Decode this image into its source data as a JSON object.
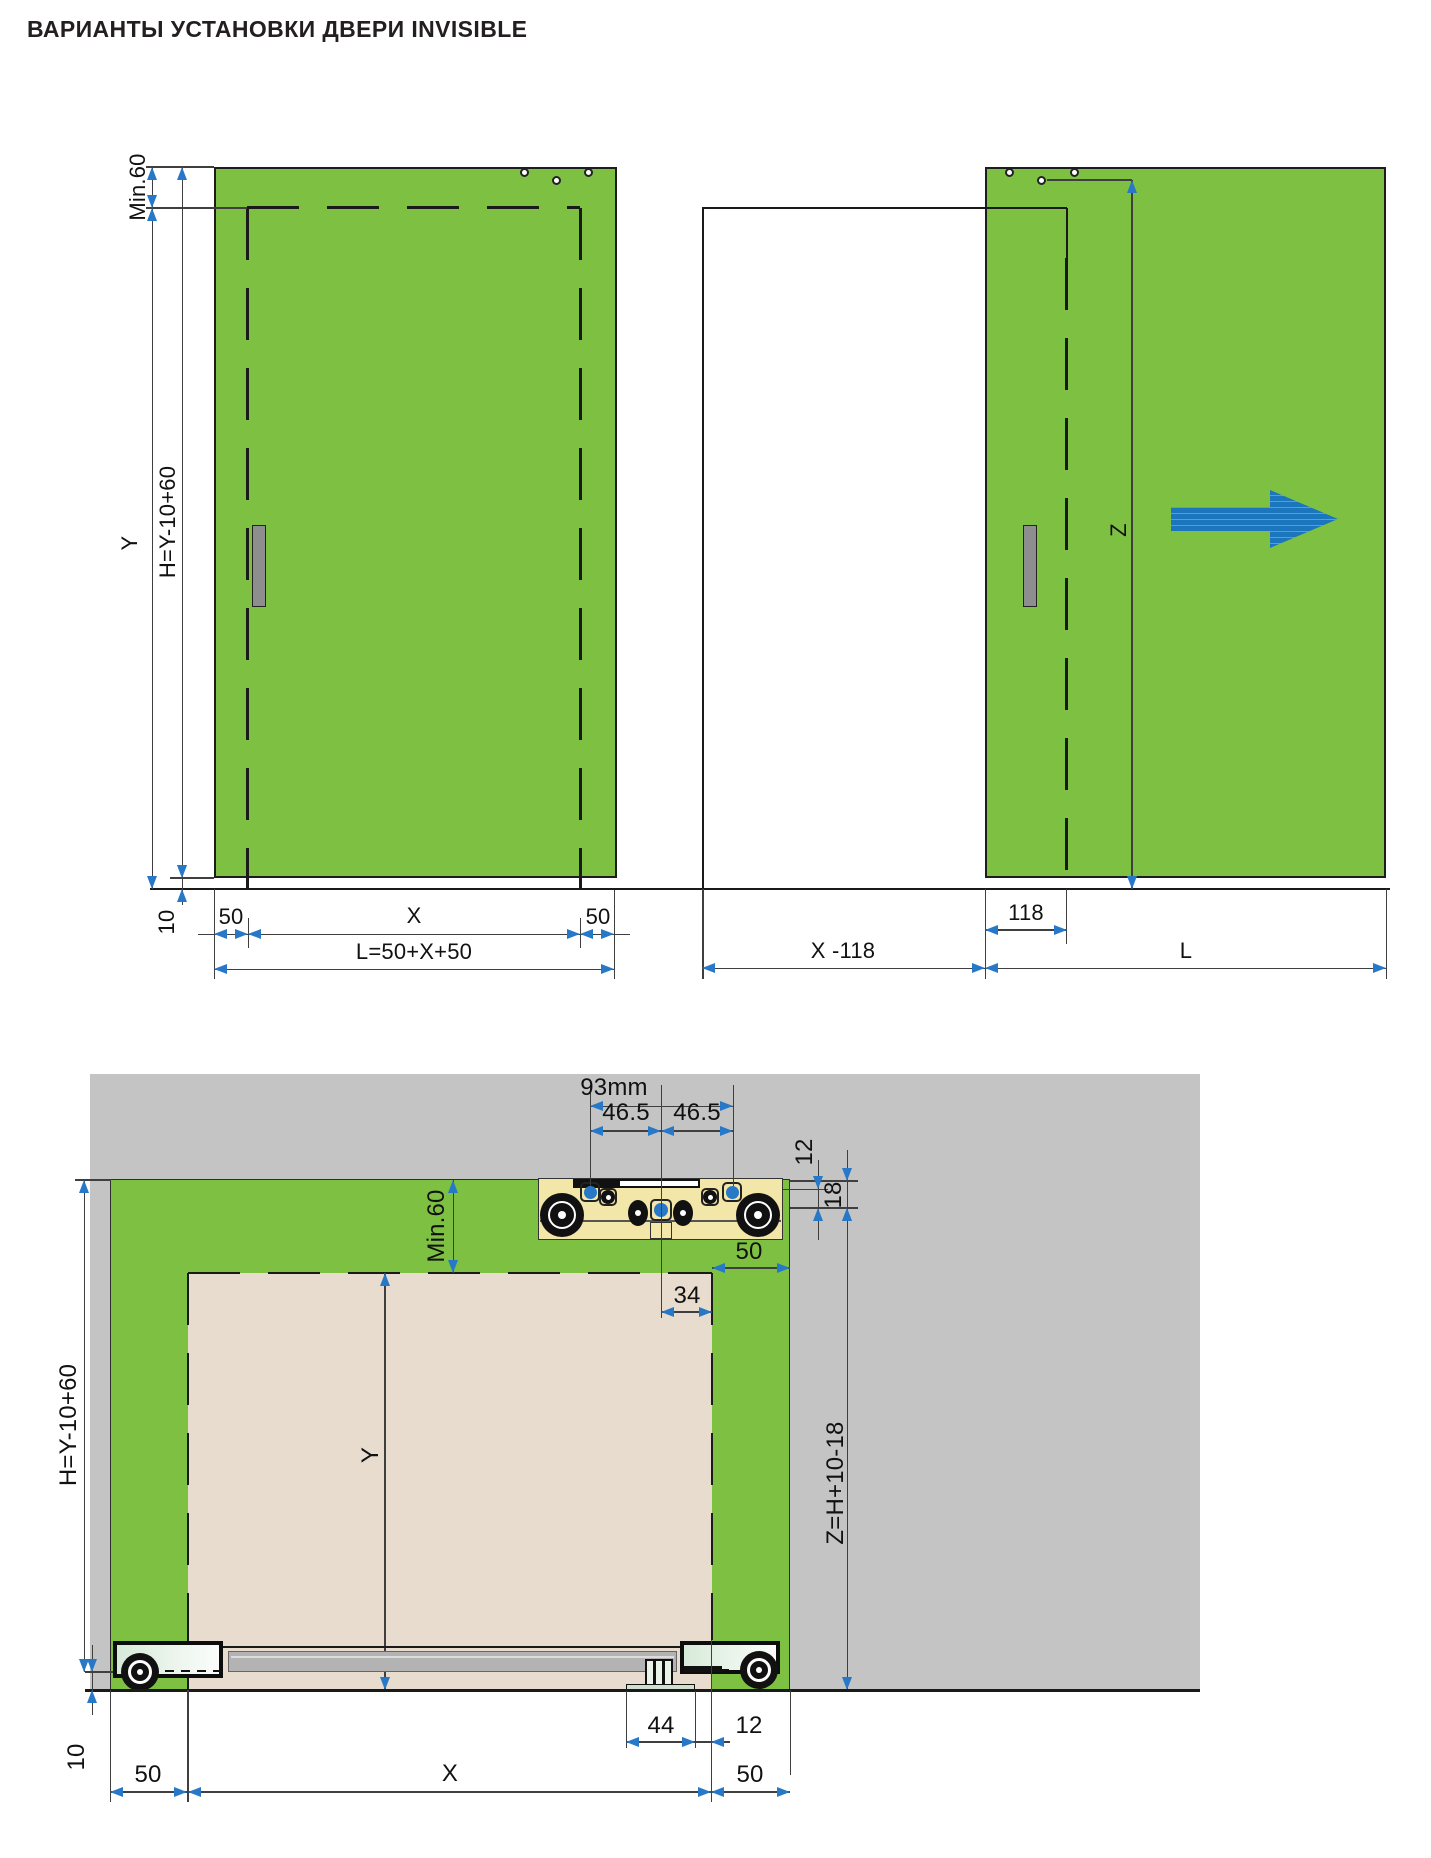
{
  "title": "ВАРИАНТЫ УСТАНОВКИ ДВЕРИ INVISIBLE",
  "colors": {
    "door_green": "#7ec142",
    "accent_blue": "#2878c8",
    "arrow_blue": "#1c76bd",
    "wall_gray": "#c5c4c4",
    "door_beige": "#e8dccf",
    "track_yellow": "#f2e7a9",
    "line_dark": "#1a1a1a"
  },
  "front_closed": {
    "min60": "Min.60",
    "y": "Y",
    "h": "H=Y-10+60",
    "gap10": "10",
    "overlap_left": "50",
    "x": "X",
    "overlap_right": "50",
    "length": "L=50+X+50"
  },
  "front_open": {
    "z": "Z",
    "d118": "118",
    "x_minus_118": "X -118",
    "length": "L"
  },
  "section": {
    "d93": "93mm",
    "d465_left": "46.5",
    "d465_right": "46.5",
    "d12_top": "12",
    "d18": "18",
    "d50_top": "50",
    "d34": "34",
    "min60": "Min.60",
    "h": "H=Y-10+60",
    "y": "Y",
    "z": "Z=H+10-18",
    "d44": "44",
    "d12_bottom": "12",
    "gap10": "10",
    "overlap_left": "50",
    "x": "X",
    "overlap_right": "50"
  }
}
